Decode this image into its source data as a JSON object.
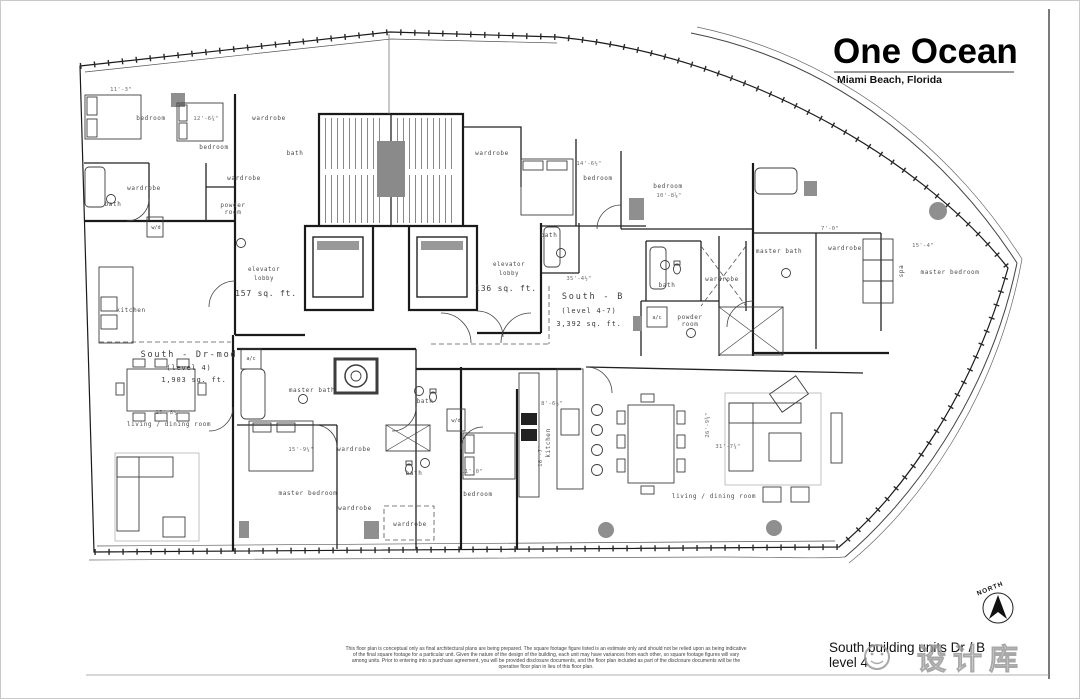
{
  "title_block": {
    "project": "One Ocean",
    "location": "Miami Beach, Florida"
  },
  "sheet_title": {
    "line1": "South building units Dr / B",
    "line2": "level 4"
  },
  "north": {
    "label": "NORTH"
  },
  "watermark": {
    "logo": "smiley-face-logo",
    "text": "设计库"
  },
  "units": [
    {
      "name": "South - Dr-mod",
      "level": "(level 4)",
      "area": "1,903 sq. ft."
    },
    {
      "name": "South - B",
      "level": "(level 4-7)",
      "area": "3,392 sq. ft."
    }
  ],
  "lobbies": [
    {
      "name_l1": "elevator",
      "name_l2": "lobby",
      "area": "157 sq. ft."
    },
    {
      "name_l1": "elevator",
      "name_l2": "lobby",
      "area": "136 sq. ft."
    }
  ],
  "rooms": [
    {
      "label": "bedroom"
    },
    {
      "label": "bedroom"
    },
    {
      "label": "wardrobe"
    },
    {
      "label": "bath"
    },
    {
      "label": "wardrobe"
    },
    {
      "label": "bath"
    },
    {
      "label": "wardrobe"
    },
    {
      "label": "powder"
    },
    {
      "label": "room"
    },
    {
      "label": "kitchen"
    },
    {
      "label": "w/d"
    },
    {
      "label": "wardrobe"
    },
    {
      "label": "bedroom"
    },
    {
      "label": "bedroom"
    },
    {
      "label": "bath"
    },
    {
      "label": "bath"
    },
    {
      "label": "wardrobe"
    },
    {
      "label": "master bath"
    },
    {
      "label": "a/c"
    },
    {
      "label": "powder"
    },
    {
      "label": "room"
    },
    {
      "label": "wardrobe"
    },
    {
      "label": "spa"
    },
    {
      "label": "master bedroom"
    },
    {
      "label": "master bath"
    },
    {
      "label": "bath"
    },
    {
      "label": "wardrobe"
    },
    {
      "label": "bath"
    },
    {
      "label": "master bedroom"
    },
    {
      "label": "wardrobe"
    },
    {
      "label": "wardrobe"
    },
    {
      "label": "bedroom"
    },
    {
      "label": "kitchen"
    },
    {
      "label": "living / dining room"
    },
    {
      "label": "living / dining room"
    },
    {
      "label": "a/c"
    },
    {
      "label": "w/d"
    }
  ],
  "dims": [
    {
      "t": "11'-3\""
    },
    {
      "t": "12'-6¾\""
    },
    {
      "t": "14'-6½\""
    },
    {
      "t": "10'-8⅞\""
    },
    {
      "t": "15'-4\""
    },
    {
      "t": "7'-0\""
    },
    {
      "t": "17'-8½\""
    },
    {
      "t": "8'-6½\""
    },
    {
      "t": "11'-0\""
    },
    {
      "t": "16'-7\""
    },
    {
      "t": "26'-9¾\""
    },
    {
      "t": "31'-7¾\""
    },
    {
      "t": "15'-9¼\""
    },
    {
      "t": "35'-4½\""
    }
  ],
  "disclaimer": {
    "l1": "This floor plan is conceptual only as final architectural plans are being prepared. The square footage figure listed is an estimate only and should not be relied upon as being indicative",
    "l2": "of the final square footage for a particular unit. Given the nature of the design of the building, each unit may have variances from each other, so square footage figures will vary",
    "l3": "among units. Prior to entering into a purchase agreement, you will be provided disclosure documents, and the floor plan included as part of the disclosure documents will be the",
    "l4": "operative floor plan in lieu of this floor plan."
  },
  "colors": {
    "wall": "#1a1a1a",
    "line": "#333333",
    "label": "#4a4a4a",
    "dim": "#6a6a6a",
    "gray_fill": "#8a8a8a",
    "watermark": "#9a9a9a"
  }
}
